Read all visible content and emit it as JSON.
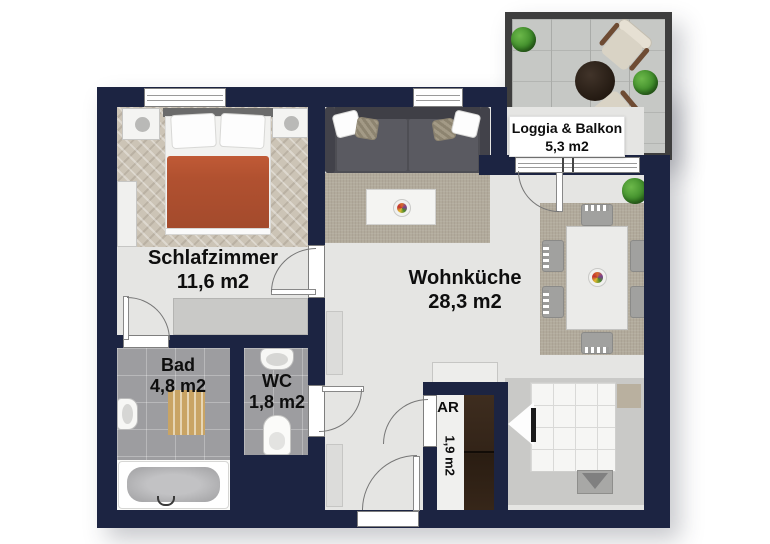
{
  "title": "Apartment floor plan",
  "rooms": {
    "schlafzimmer": {
      "name": "Schlafzimmer",
      "area": "11,6 m2"
    },
    "wohnkueche": {
      "name": "Wohnküche",
      "area": "28,3 m2"
    },
    "bad": {
      "name": "Bad",
      "area": "4,8 m2"
    },
    "wc": {
      "name": "WC",
      "area": "1,8 m2"
    },
    "ar": {
      "name": "AR",
      "area": "1,9 m2"
    },
    "loggia": {
      "name": "Loggia & Balkon",
      "area": "5,3 m2"
    }
  },
  "colors": {
    "wall": "#1c2442",
    "balcony_wall": "#3e3e3e",
    "floor": "#e5e5e3",
    "tile": "#9d9da0",
    "carpet": "#ccc4b6",
    "rug": "#b2ab9c",
    "blanket": "#b15130",
    "sofa": "#4e4e54",
    "cabinet_brown": "#332418",
    "bath_mat": "#c9a464",
    "plant_green": "#3c8a28"
  }
}
